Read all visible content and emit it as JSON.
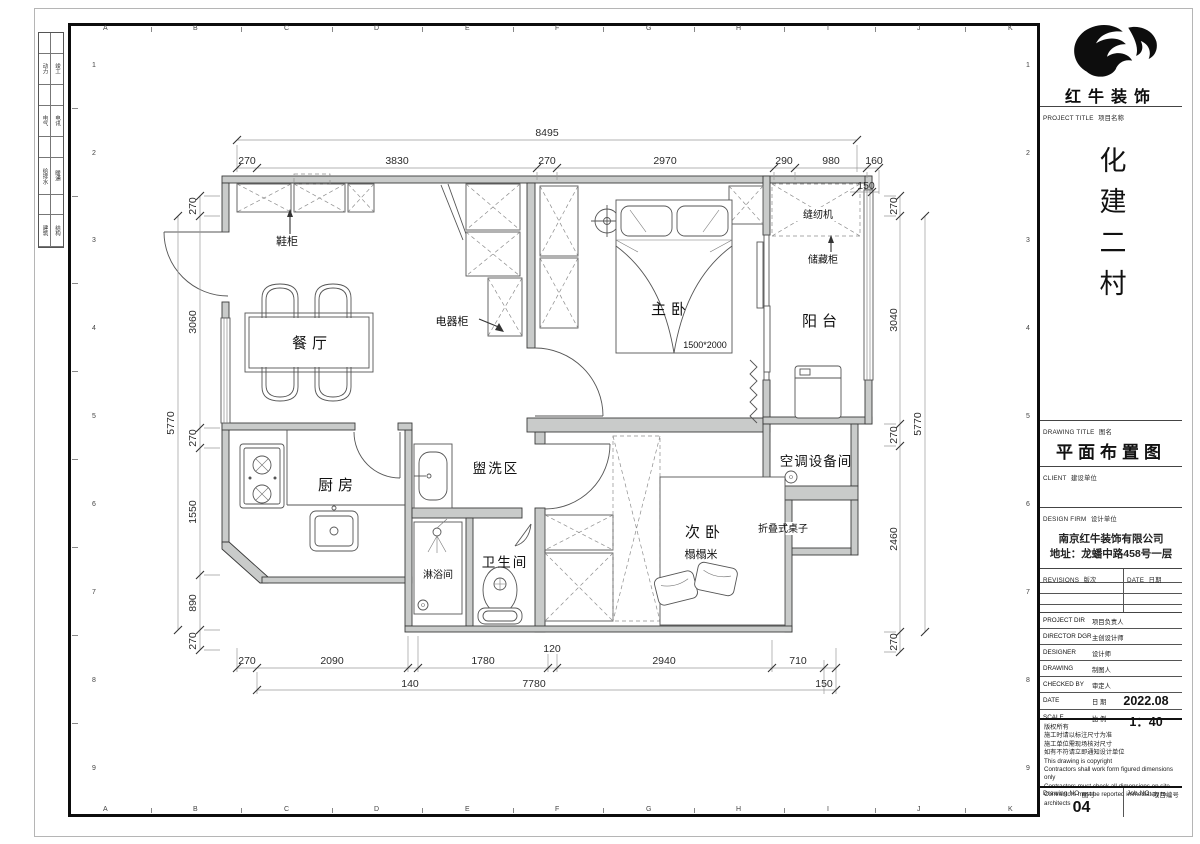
{
  "sheet": {
    "grid_letters": [
      "A",
      "B",
      "C",
      "D",
      "E",
      "F",
      "G",
      "H",
      "I",
      "J",
      "K"
    ],
    "grid_rows": [
      "1",
      "2",
      "3",
      "4",
      "5",
      "6",
      "7",
      "8",
      "9"
    ],
    "stamps": [
      [
        "动力",
        "竣工"
      ],
      [
        "电气",
        "电讯"
      ],
      [
        "给排水",
        "暖通"
      ],
      [
        "建筑",
        "结构"
      ]
    ]
  },
  "title_block": {
    "brand": "红牛装饰",
    "project_title_en": "PROJECT TITLE",
    "project_title_cn": "项目名称",
    "project_name": "化建二村",
    "drawing_title_en": "DRAWING TITLE",
    "drawing_title_cn": "图名",
    "drawing_title": "平面布置图",
    "client_en": "CLIENT",
    "client_cn": "建设单位",
    "firm_en": "DESIGN FIRM",
    "firm_cn": "设计单位",
    "firm_name": "南京红牛装饰有限公司",
    "firm_addr": "地址：龙蟠中路458号一层",
    "rev_en": "REVISIONS",
    "rev_cn": "版次",
    "date_en": "DATE",
    "date_cn": "日期",
    "rows": [
      {
        "en": "PROJECT DIR",
        "cn": "项目负责人",
        "value": ""
      },
      {
        "en": "DIRECTOR DGR",
        "cn": "主创设计师",
        "value": ""
      },
      {
        "en": "DESIGNER",
        "cn": "设计师",
        "value": ""
      },
      {
        "en": "DRAWING",
        "cn": "制图人",
        "value": ""
      },
      {
        "en": "CHECKED BY",
        "cn": "审定人",
        "value": ""
      },
      {
        "en": "DATE",
        "cn": "日 期",
        "value": "2022.08"
      },
      {
        "en": "SCALE",
        "cn": "比 例",
        "value": "1：40"
      }
    ],
    "notes": [
      "版权所有",
      "施工时请以标注尺寸为准",
      "施工单位需现场核对尺寸",
      "如有不符请立即通知设计单位",
      "This drawing is copyright",
      "Contractors shall work form figured dimensions only",
      "Contractors must check all dimensions on site",
      "Contractors must be reported immediately to architects"
    ],
    "dno_en": "Drawing NO",
    "dno_cn": "图号",
    "dno": "04",
    "jno_en": "Job NO",
    "jno_cn": "项目编号"
  },
  "plan": {
    "labels": {
      "dining": "餐厅",
      "kitchen": "厨房",
      "wash": "盥洗区",
      "wc": "卫生间",
      "shower": "淋浴间",
      "master": "主卧",
      "second": "次卧",
      "balcony": "阳台",
      "ac": "空调设备间",
      "shoe": "鞋柜",
      "appliance": "电器柜",
      "sewing": "缝纫机",
      "storage": "储藏柜",
      "tatami": "榻榻米",
      "folding": "折叠式桌子",
      "bed_size": "1500*2000"
    },
    "dims": {
      "top": {
        "overall": "8495",
        "segs": [
          "270",
          "3830",
          "270",
          "2970",
          "290",
          "980",
          "160"
        ],
        "offset": "150"
      },
      "bottom": {
        "row1": [
          "270",
          "2090",
          "1780",
          "120",
          "2940",
          "710"
        ],
        "row2": [
          "140",
          "7780",
          "150"
        ]
      },
      "left": {
        "overall": "5770",
        "segs": [
          "270",
          "3060",
          "270",
          "1550",
          "890",
          "270"
        ]
      },
      "right": {
        "overall": "5770",
        "segs": [
          "270",
          "3040",
          "270",
          "2460",
          "270"
        ]
      }
    }
  }
}
